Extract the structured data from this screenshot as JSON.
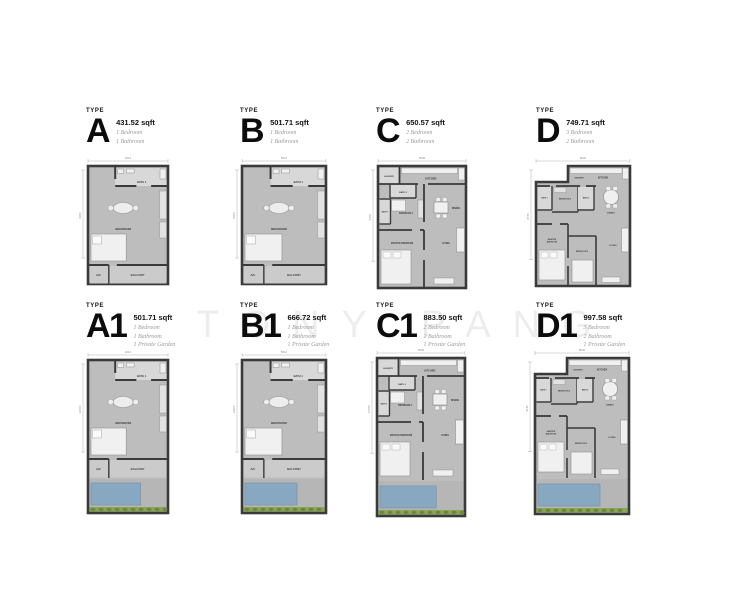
{
  "watermark": "TONY PANG",
  "colors": {
    "wall": "#3a3a3a",
    "floor": "#bdbdbd",
    "floor_light": "#d8d8d8",
    "balcony": "#cbcbcb",
    "fixture": "#f0f0f0",
    "pool": "#87a8c0",
    "green": "#8aa653"
  },
  "units": [
    {
      "id": "A",
      "type_label": "TYPE",
      "name": "A",
      "area": "431.52 sqft",
      "features": [
        "1 Bedroom",
        "1 Bathroom"
      ],
      "dims": {
        "width": "4012",
        "depth": "9300"
      },
      "rooms": {
        "bath1": "BATH 1",
        "bedroom": "BEDROOM",
        "ac": "A/C",
        "balcony": "BALCONY"
      }
    },
    {
      "id": "B",
      "type_label": "TYPE",
      "name": "B",
      "area": "501.71 sqft",
      "features": [
        "1 Bedroom",
        "1 Bathroom"
      ],
      "dims": {
        "width": "5012",
        "depth": "9300"
      },
      "rooms": {
        "bath1": "BATH 1",
        "bedroom": "BEDROOM",
        "ac": "A/C",
        "balcony": "BALCONY"
      }
    },
    {
      "id": "C",
      "type_label": "TYPE",
      "name": "C",
      "area": "650.57 sqft",
      "features": [
        "2 Bedroom",
        "2 Bathroom"
      ],
      "dims": {
        "width": "5535",
        "depth": "9300"
      },
      "rooms": {
        "laundry": "LAUNDRY",
        "kitchen": "KITCHEN",
        "bath2": "BATH 2",
        "bedroom2": "BEDROOM 2",
        "dining": "DINING",
        "bath1": "BATH 1",
        "master": "MASTER BEDROOM",
        "living": "LIVING"
      }
    },
    {
      "id": "D",
      "type_label": "TYPE",
      "name": "D",
      "area": "749.71 sqft",
      "features": [
        "3 Bedroom",
        "2 Bathroom"
      ],
      "dims": {
        "width": "8092",
        "depth": "8745"
      },
      "rooms": {
        "laundry": "LAUNDRY",
        "kitchen": "KITCHEN",
        "bath1": "BATH 1",
        "bedroom3": "BEDROOM 3",
        "bath2": "BATH 2",
        "dining": "DINING",
        "master": "MASTER BEDROOM",
        "bedroom2": "BEDROOM 2",
        "living": "LIVING"
      }
    },
    {
      "id": "A1",
      "type_label": "TYPE",
      "name": "A1",
      "area": "501.71 sqft",
      "features": [
        "1 Bedroom",
        "1 Bathroom",
        "1 Private Garden"
      ],
      "dims": {
        "width": "4012",
        "depth": "12000"
      },
      "rooms": {
        "bath1": "BATH 1",
        "bedroom": "BEDROOM",
        "ac": "A/C",
        "balcony": "BALCONY"
      }
    },
    {
      "id": "B1",
      "type_label": "TYPE",
      "name": "B1",
      "area": "666.72 sqft",
      "features": [
        "1 Bedroom",
        "1 Bathroom",
        "1 Private Garden"
      ],
      "dims": {
        "width": "5012",
        "depth": "12000"
      },
      "rooms": {
        "bath1": "BATH 1",
        "bedroom": "BEDROOM",
        "ac": "A/C",
        "balcony": "BALCONY"
      }
    },
    {
      "id": "C1",
      "type_label": "TYPE",
      "name": "C1",
      "area": "883.50 sqft",
      "features": [
        "2 Bedroom",
        "2 Bathroom",
        "1 Private Garden"
      ],
      "dims": {
        "width": "5535",
        "depth": "12030"
      },
      "rooms": {
        "laundry": "LAUNDRY",
        "kitchen": "KITCHEN",
        "bath2": "BATH 2",
        "bedroom2": "BEDROOM 2",
        "dining": "DINING",
        "bath1": "BATH 1",
        "master": "MASTER BEDROOM",
        "living": "LIVING"
      }
    },
    {
      "id": "D1",
      "type_label": "TYPE",
      "name": "D1",
      "area": "997.58 sqft",
      "features": [
        "3 Bedroom",
        "2 Bathroom",
        "1 Private Garden"
      ],
      "dims": {
        "width": "8092",
        "depth": "9745"
      },
      "rooms": {
        "laundry": "LAUNDRY",
        "kitchen": "KITCHEN",
        "bath1": "BATH 1",
        "bedroom3": "BEDROOM 3",
        "bath2": "BATH 2",
        "dining": "DINING",
        "master": "MASTER BEDROOM",
        "bedroom2": "BEDROOM 2",
        "living": "LIVING"
      }
    }
  ]
}
